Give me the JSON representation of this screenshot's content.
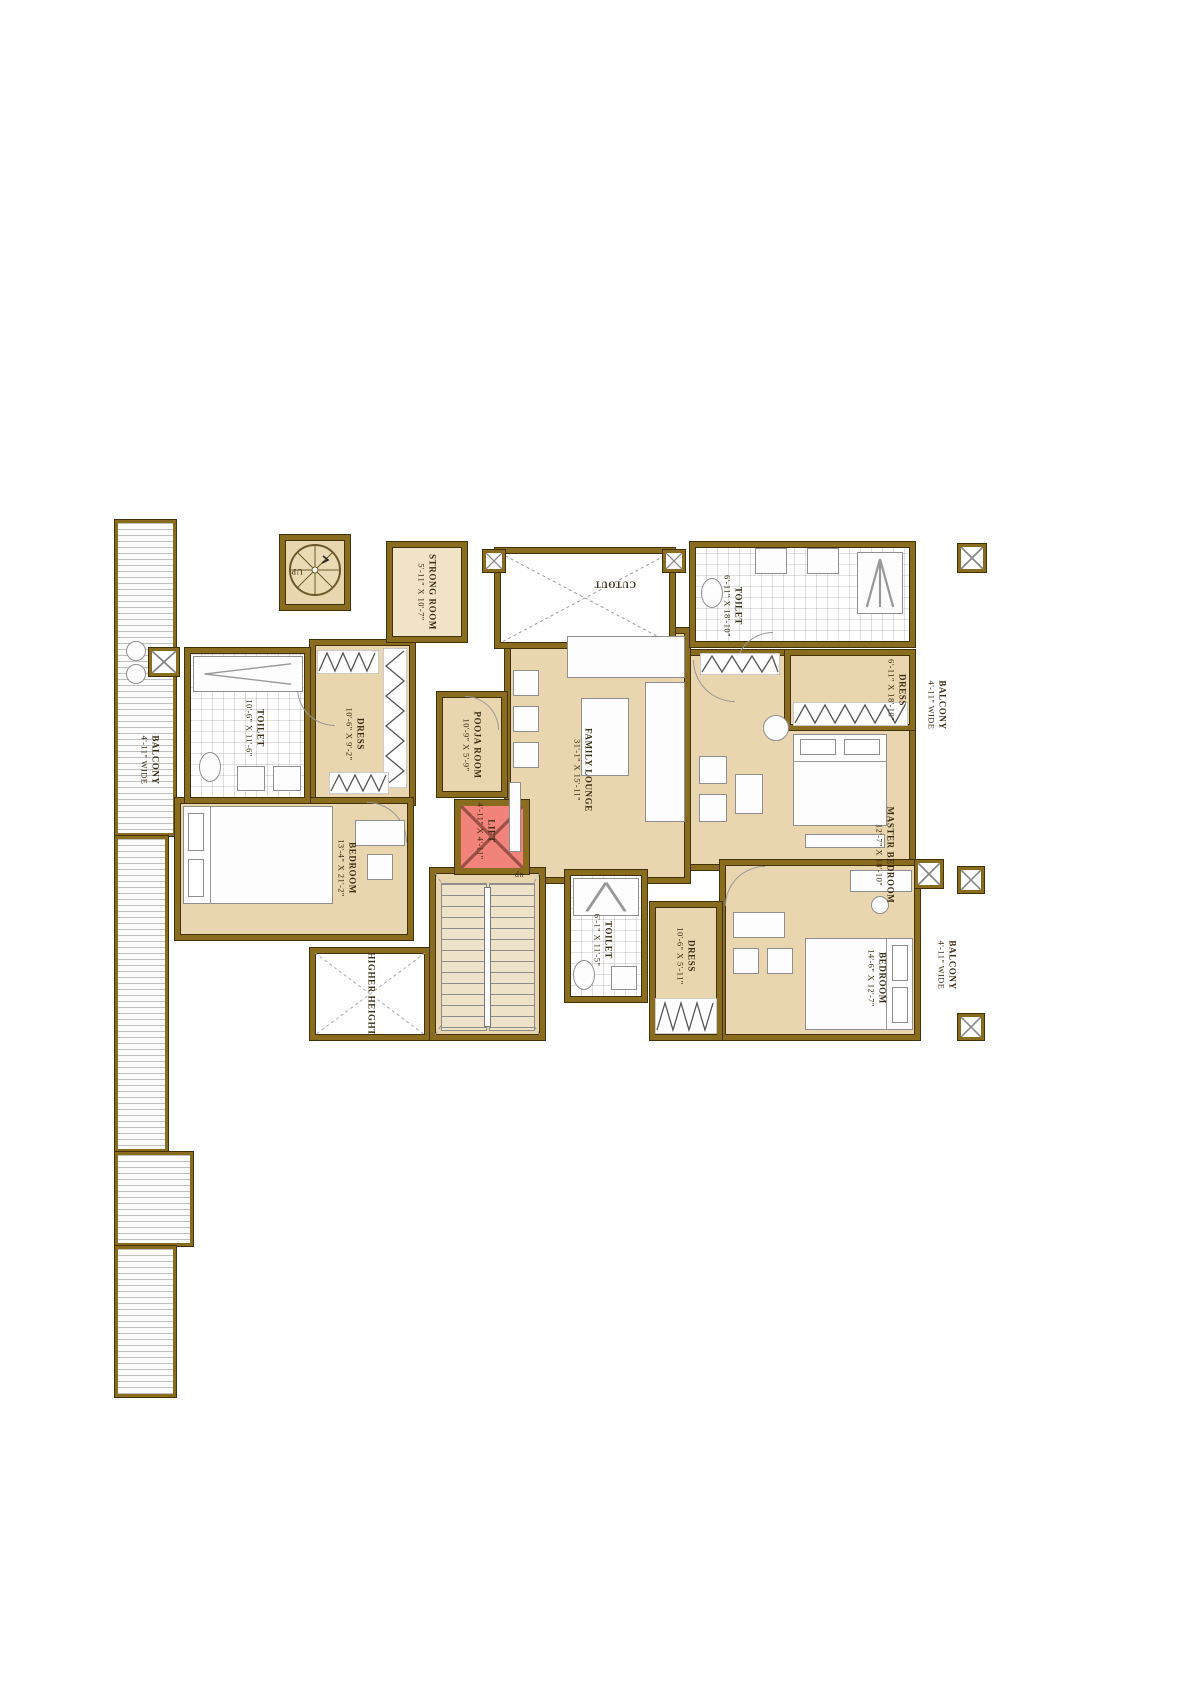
{
  "plan": {
    "colors": {
      "wall": "#8a6c1e",
      "wall_outline": "#41320b",
      "floor": "#e9d5ae",
      "floor_light": "#f1e4c6",
      "lift_fill": "#f2837b",
      "hatch_line": "#c0c0c0"
    },
    "rooms": {
      "strong_room": {
        "name": "STRONG ROOM",
        "dims": "5'-11\" X 10'-7\""
      },
      "cutout_top": {
        "name": "CUTOUT"
      },
      "toilet_master": {
        "name": "TOILET",
        "dims": "6'-11\" X 18'-10\""
      },
      "dress_master": {
        "name": "DRESS",
        "dims": "6'-11\" X 18'-10\""
      },
      "balcony_right": {
        "name": "BALCONY",
        "dims": "4'-11\" WIDE"
      },
      "master_bedroom": {
        "name": "MASTER BEDROOM",
        "dims": "12'-7\" X 18'-10\""
      },
      "toilet_left": {
        "name": "TOILET",
        "dims": "10'-6\" X 11'-6\""
      },
      "dress_left": {
        "name": "DRESS",
        "dims": "10'-6\" X 9'-2\""
      },
      "pooja_room": {
        "name": "POOJA ROOM",
        "dims": "10'-9\" X 5'-9\""
      },
      "lift": {
        "name": "LIFT",
        "dims": "4'-11\" X 4'-11\""
      },
      "family_lounge": {
        "name": "FAMILY LOUNGE",
        "dims": "31'-1\" X 15'-11\""
      },
      "bedroom_left": {
        "name": "BEDROOM",
        "dims": "13'-4\" X 21'-2\""
      },
      "balcony_left": {
        "name": "BALCONY",
        "dims": "4'-11\" WIDE"
      },
      "cutout_bottom": {
        "name": "HIGHER HEIGHT"
      },
      "toilet_bottom": {
        "name": "TOILET",
        "dims": "6'-1\" X 11'-5\""
      },
      "dress_bottom": {
        "name": "DRESS",
        "dims": "10'-6\" X 5'-11\""
      },
      "bedroom_bottom": {
        "name": "BEDROOM",
        "dims": "14'-6\" X 12'-7\""
      },
      "balcony_bottom": {
        "name": "BALCONY",
        "dims": "4'-11\" WIDE"
      }
    },
    "stairs": {
      "spiral_label": "UP",
      "main_label": "up"
    }
  }
}
